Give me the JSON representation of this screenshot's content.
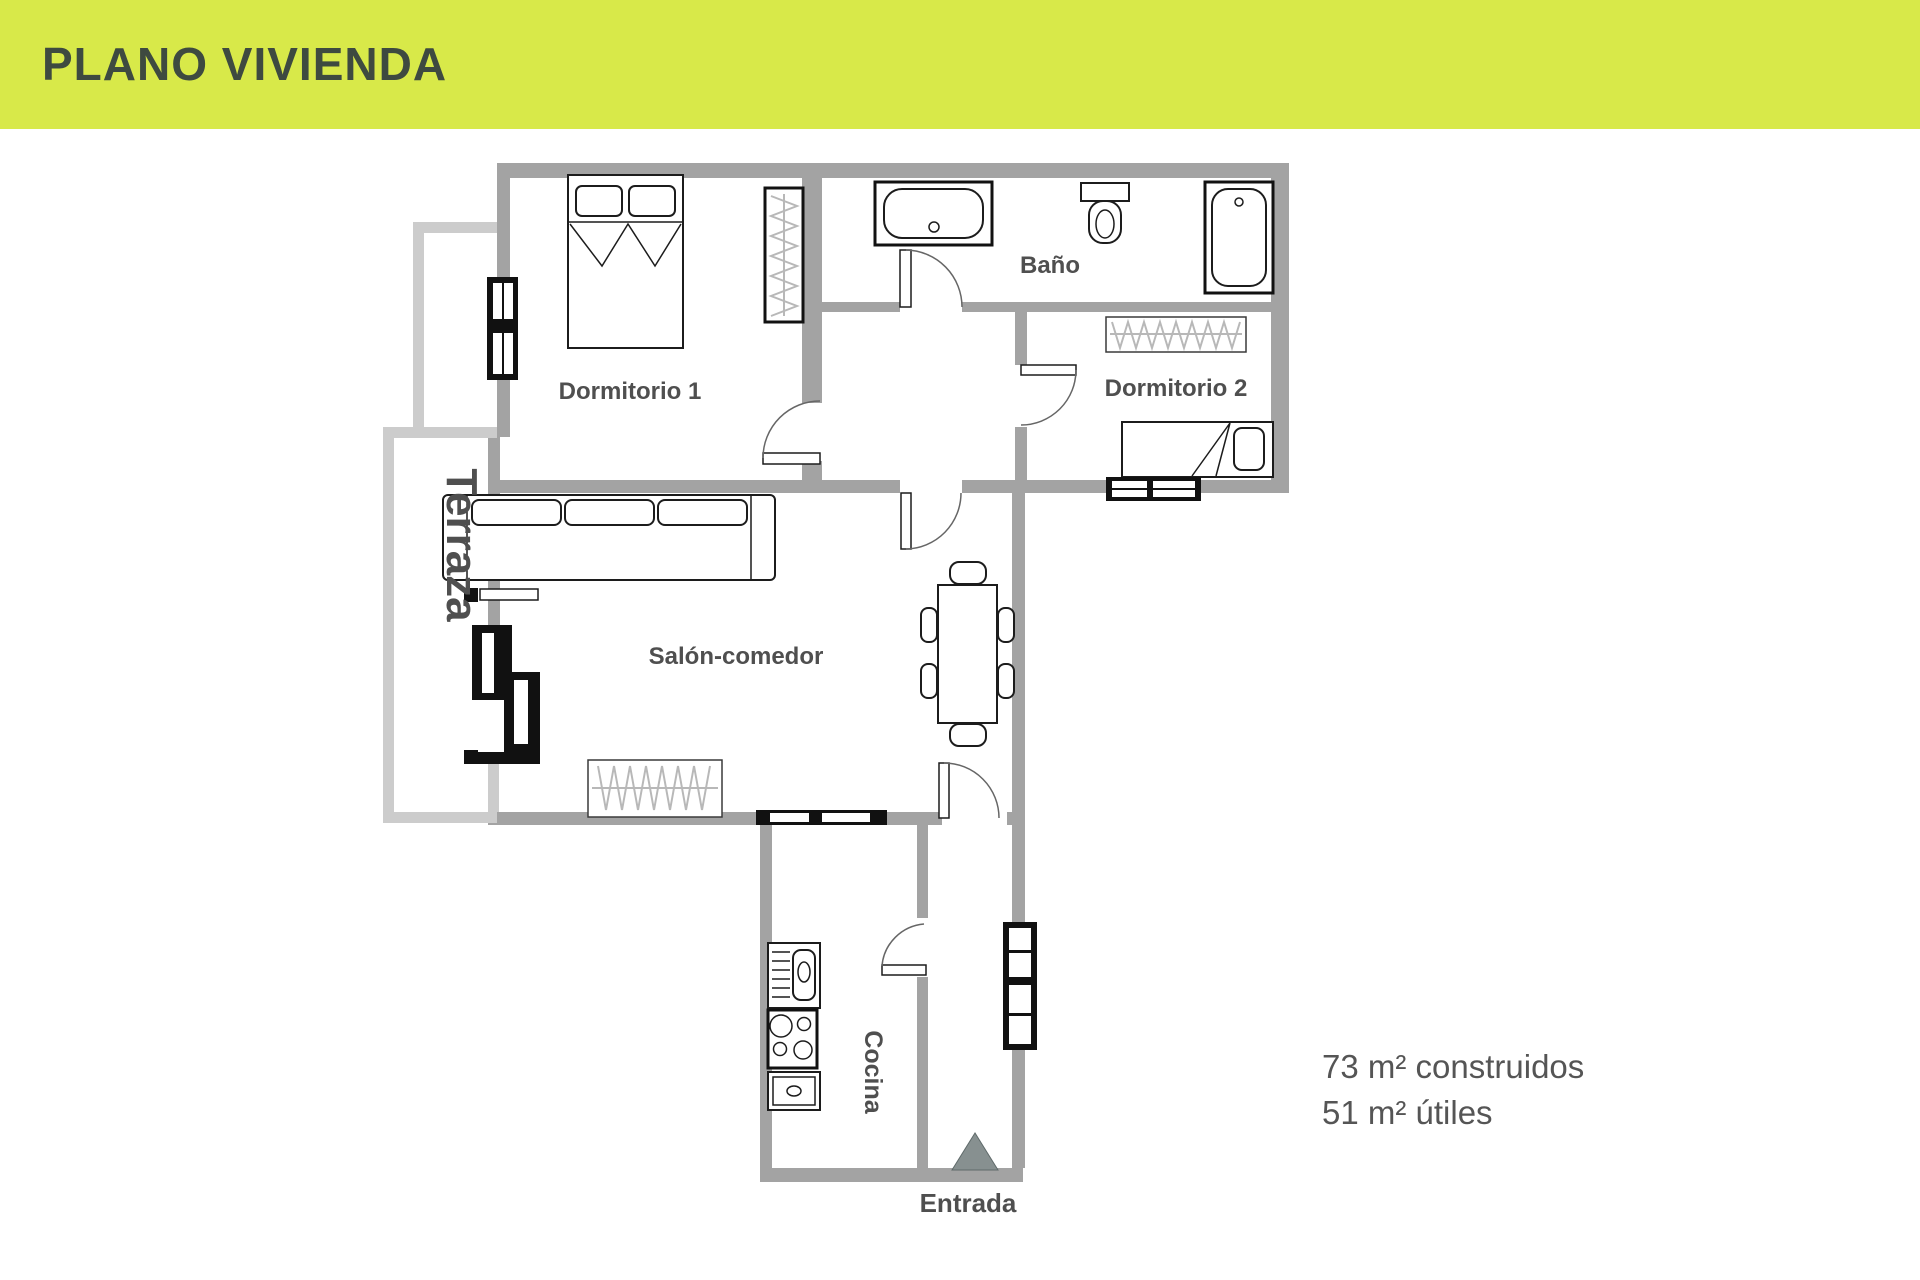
{
  "header": {
    "title": "PLANO VIVIENDA"
  },
  "labels": {
    "dormitorio1": "Dormitorio 1",
    "bano": "Baño",
    "dormitorio2": "Dormitorio 2",
    "terraza": "Terraza",
    "salon": "Salón-comedor",
    "cocina": "Cocina",
    "entrada": "Entrada"
  },
  "area_info": {
    "constructed": "73 m² construidos",
    "useful": "51 m² útiles"
  },
  "colors": {
    "header_bg": "#d8e949",
    "header_text": "#3e4a40",
    "wall": "#a3a3a3",
    "terrace_wall": "#cccccc",
    "label_text": "#4f4f4f",
    "area_text": "#555555",
    "furniture_stroke": "#1c1c1c",
    "entry_triangle": "#879090"
  }
}
